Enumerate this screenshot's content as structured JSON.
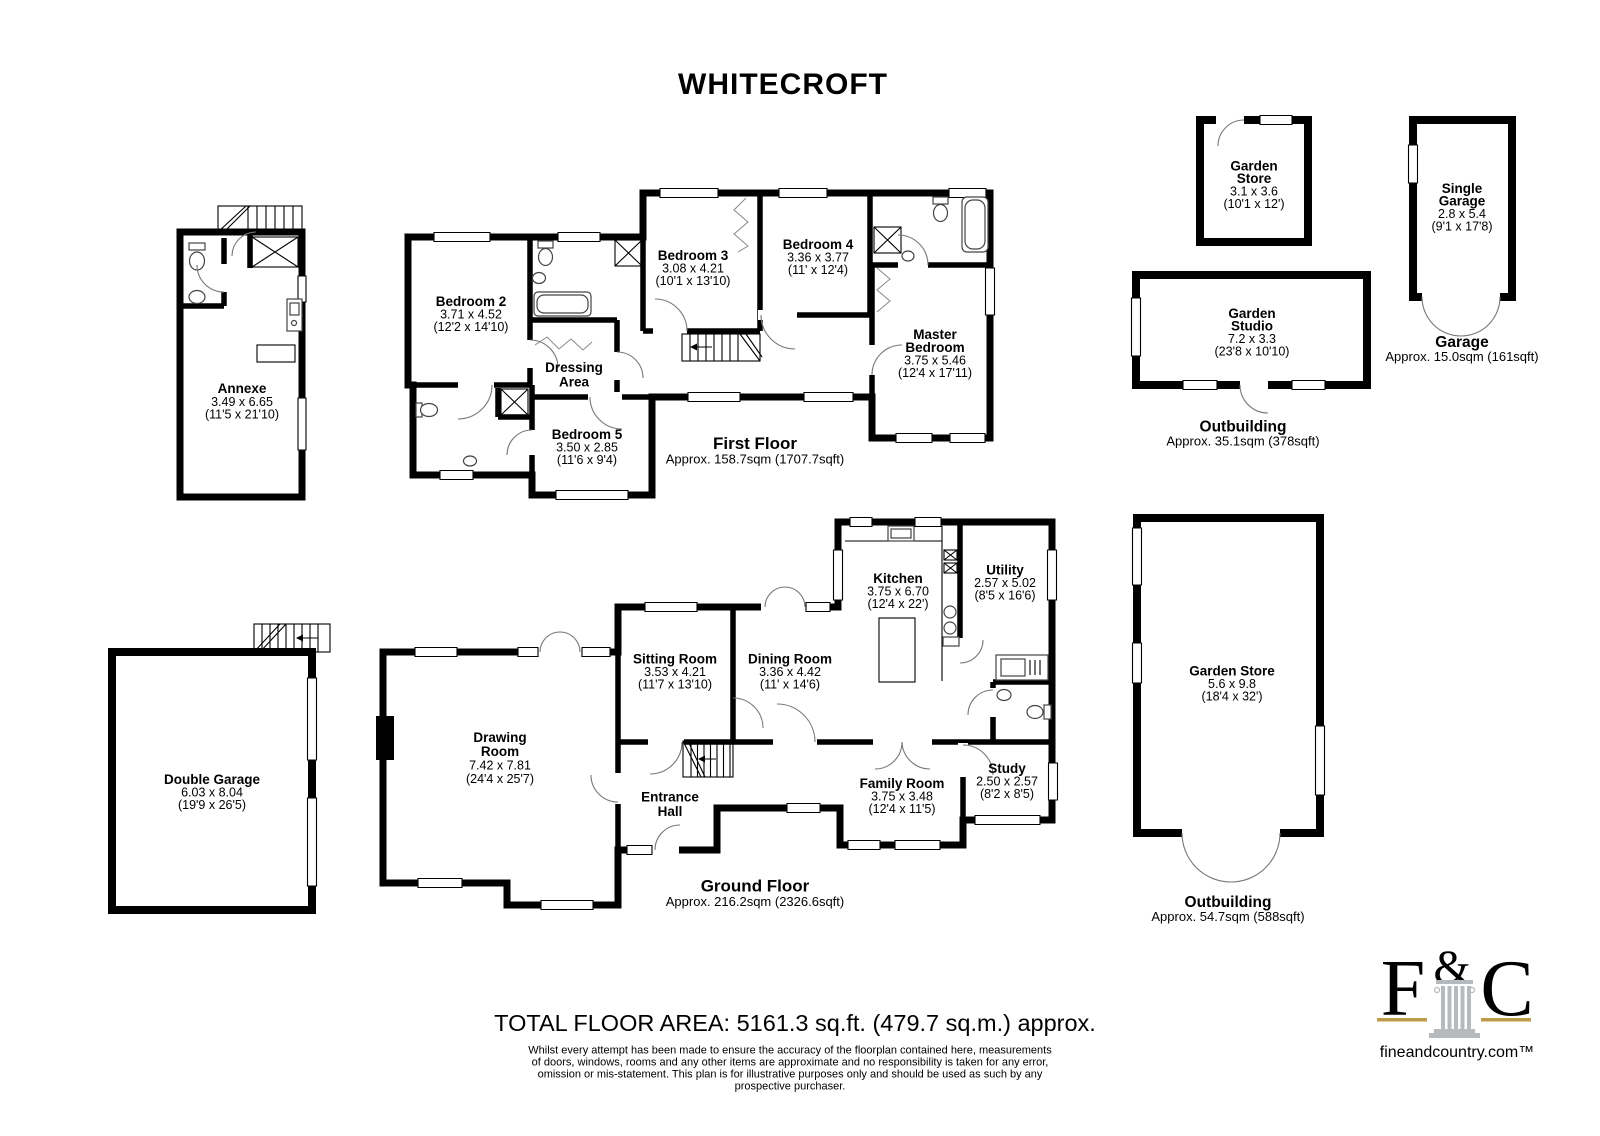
{
  "title": "WHITECROFT",
  "annexe": {
    "n": "Annexe",
    "m": "3.49 x 6.65",
    "f": "(11'5 x 21'10)"
  },
  "first": {
    "b2": {
      "n": "Bedroom 2",
      "m": "3.71 x 4.52",
      "f": "(12'2 x 14'10)"
    },
    "b3": {
      "n": "Bedroom 3",
      "m": "3.08 x 4.21",
      "f": "(10'1 x 13'10)"
    },
    "b4": {
      "n": "Bedroom 4",
      "m": "3.36 x 3.77",
      "f": "(11' x 12'4)"
    },
    "b5": {
      "n": "Bedroom 5",
      "m": "3.50 x 2.85",
      "f": "(11'6 x 9'4)"
    },
    "master": {
      "n1": "Master",
      "n2": "Bedroom",
      "m": "3.75 x 5.46",
      "f": "(12'4 x 17'11)"
    },
    "dressing": {
      "n1": "Dressing",
      "n2": "Area"
    },
    "caption": "First Floor",
    "area": "Approx. 158.7sqm (1707.7sqft)"
  },
  "ground": {
    "drawing": {
      "n1": "Drawing",
      "n2": "Room",
      "m": "7.42 x 7.81",
      "f": "(24'4 x 25'7)"
    },
    "sitting": {
      "n": "Sitting Room",
      "m": "3.53 x 4.21",
      "f": "(11'7 x 13'10)"
    },
    "dining": {
      "n": "Dining Room",
      "m": "3.36 x 4.42",
      "f": "(11' x 14'6)"
    },
    "kitchen": {
      "n": "Kitchen",
      "m": "3.75 x 6.70",
      "f": "(12'4 x 22')"
    },
    "utility": {
      "n": "Utility",
      "m": "2.57 x 5.02",
      "f": "(8'5 x 16'6)"
    },
    "entrance": {
      "n1": "Entrance",
      "n2": "Hall"
    },
    "family": {
      "n": "Family Room",
      "m": "3.75 x 3.48",
      "f": "(12'4 x 11'5)"
    },
    "study": {
      "n": "Study",
      "m": "2.50 x 2.57",
      "f": "(8'2 x 8'5)"
    },
    "caption": "Ground Floor",
    "area": "Approx. 216.2sqm (2326.6sqft)"
  },
  "out": {
    "store_sm": {
      "n1": "Garden",
      "n2": "Store",
      "m": "3.1 x 3.6",
      "f": "(10'1 x 12')"
    },
    "garage1": {
      "n1": "Single",
      "n2": "Garage",
      "m": "2.8 x 5.4",
      "f": "(9'1 x 17'8)"
    },
    "garage1_cap": "Garage",
    "garage1_area": "Approx. 15.0sqm (161sqft)",
    "studio": {
      "n1": "Garden",
      "n2": "Studio",
      "m": "7.2 x 3.3",
      "f": "(23'8 x 10'10)"
    },
    "studio_cap": "Outbuilding",
    "studio_area": "Approx. 35.1sqm (378sqft)",
    "store_lg": {
      "n": "Garden Store",
      "m": "5.6 x 9.8",
      "f": "(18'4 x 32')"
    },
    "store_lg_cap": "Outbuilding",
    "store_lg_area": "Approx. 54.7sqm (588sqft)",
    "dgarage": {
      "n": "Double Garage",
      "m": "6.03 x 8.04",
      "f": "(19'9 x 26'5)"
    }
  },
  "footer": {
    "total": "TOTAL FLOOR AREA: 5161.3 sq.ft. (479.7 sq.m.) approx.",
    "d1": "Whilst every attempt has been made to ensure the accuracy of the floorplan contained here, measurements",
    "d2": "of doors, windows, rooms and any other items are approximate and no responsibility is taken for any error,",
    "d3": "omission or mis-statement. This plan is for illustrative purposes only and should be used as such by any",
    "d4": "prospective purchaser."
  },
  "logo": {
    "f": "F",
    "amp": "&",
    "c": "C",
    "site": "fineandcountry.com™"
  },
  "colors": {
    "wall": "#000000",
    "gold": "#bd9b49",
    "column": "#b7babc",
    "logo_text": "#3c3c3c"
  }
}
